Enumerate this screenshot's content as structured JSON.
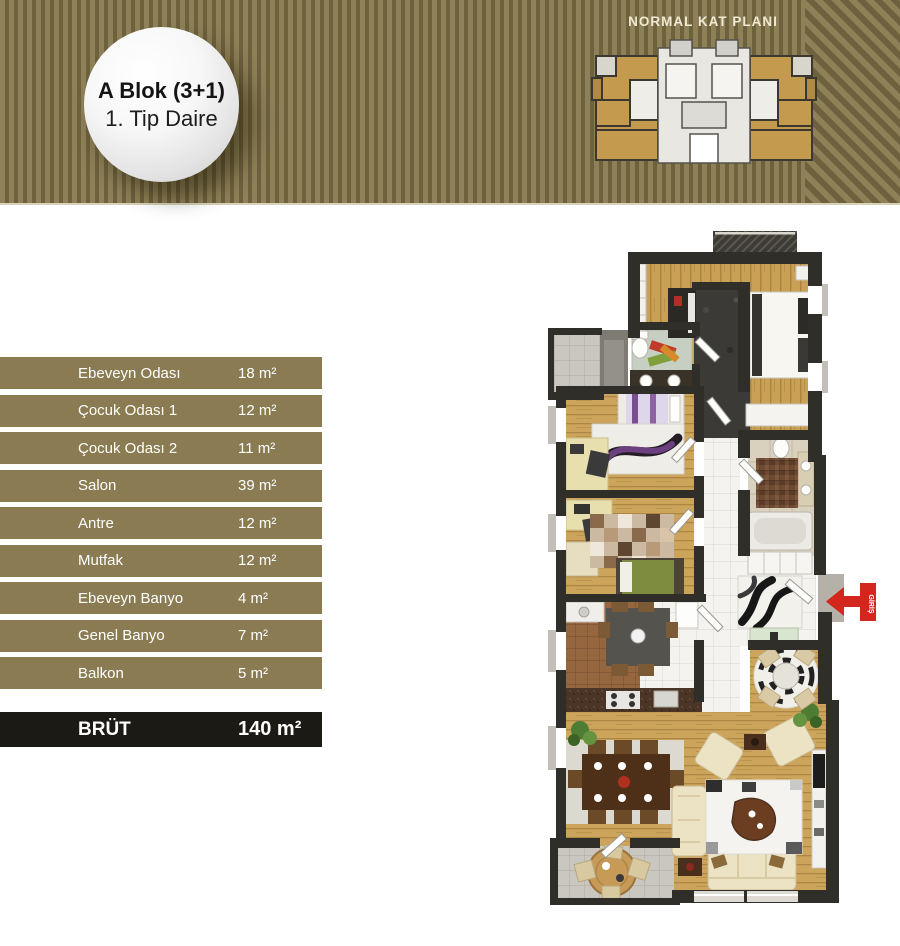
{
  "banner": {
    "badge": {
      "line1": "A Blok (3+1)",
      "line2": "1. Tip Daire"
    },
    "keyplan_title": "NORMAL KAT PLANI"
  },
  "table": {
    "rows": [
      {
        "label": "Ebeveyn Odası",
        "value": "18 m²"
      },
      {
        "label": "Çocuk Odası 1",
        "value": "12 m²"
      },
      {
        "label": "Çocuk Odası 2",
        "value": "11 m²"
      },
      {
        "label": "Salon",
        "value": "39 m²"
      },
      {
        "label": "Antre",
        "value": "12 m²"
      },
      {
        "label": "Mutfak",
        "value": "12 m²"
      },
      {
        "label": "Ebeveyn Banyo",
        "value": "4 m²"
      },
      {
        "label": "Genel Banyo",
        "value": "7 m²"
      },
      {
        "label": "Balkon",
        "value": "5 m²"
      }
    ],
    "total": {
      "label": "BRÜT",
      "value": "140 m²"
    }
  },
  "floorplan": {
    "entrance_label": "GİRİŞ"
  },
  "colors": {
    "stripe-a": "#8e8157",
    "stripe-b": "#6e613e",
    "banner-edge": "#d8d1b8",
    "row-bg": "#8a7b52",
    "row-text": "#ffffff",
    "total-bg": "#1c1a14",
    "accent-red": "#d3261d"
  }
}
